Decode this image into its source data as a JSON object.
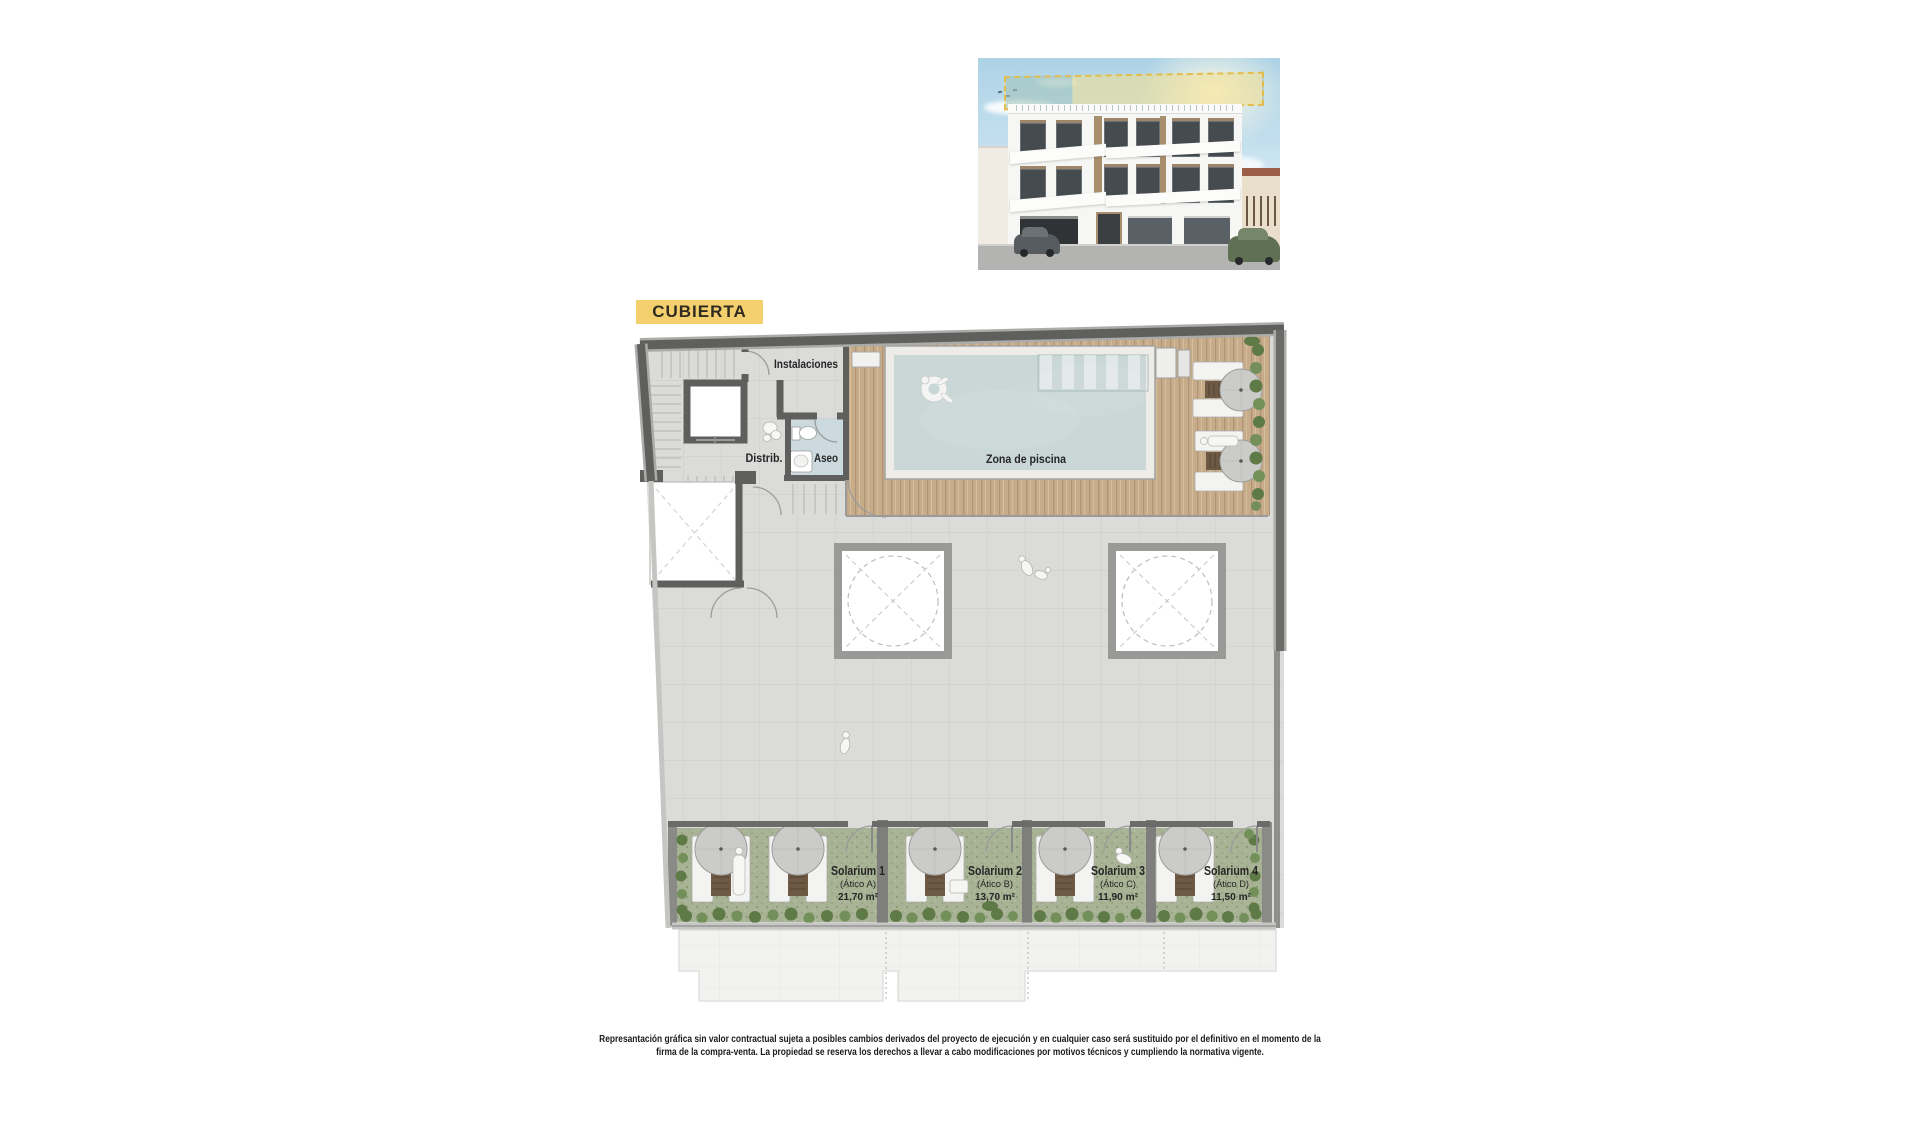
{
  "badge": {
    "label": "CUBIERTA"
  },
  "plan": {
    "labels": {
      "instalaciones": "Instalaciones",
      "distrib": "Distrib.",
      "aseo": "Aseo",
      "pool_zone": "Zona de piscina"
    },
    "solariums": [
      {
        "name": "Solarium 1",
        "unit": "(Ático A)",
        "area": "21,70 m²"
      },
      {
        "name": "Solarium 2",
        "unit": "(Ático B)",
        "area": "13,70 m²"
      },
      {
        "name": "Solarium 3",
        "unit": "(Ático C)",
        "area": "11,90 m²"
      },
      {
        "name": "Solarium 4",
        "unit": "(Ático D)",
        "area": "11,50 m²"
      }
    ]
  },
  "footer": {
    "line1": "Represantación gráfica sin valor contractual sujeta a posibles cambios derivados del proyecto de ejecución y en cualquier caso será sustituido por el definitivo en el momento de la",
    "line2": "firma de la compra-venta. La propiedad se reserva los derechos a llevar a cabo modificaciones por motivos técnicos y cumpliendo la normativa vigente."
  },
  "colors": {
    "badge_bg": "#f4cf6d",
    "wall": "#5f5f5d",
    "tile": "#dbdbd9",
    "wood": "#c7ac8a",
    "water": "#c9d7d6",
    "grass": "#a8b295",
    "green": "#5e7a46",
    "aseo": "#ccd9df",
    "highlight_dash": "#e2bd4e"
  }
}
